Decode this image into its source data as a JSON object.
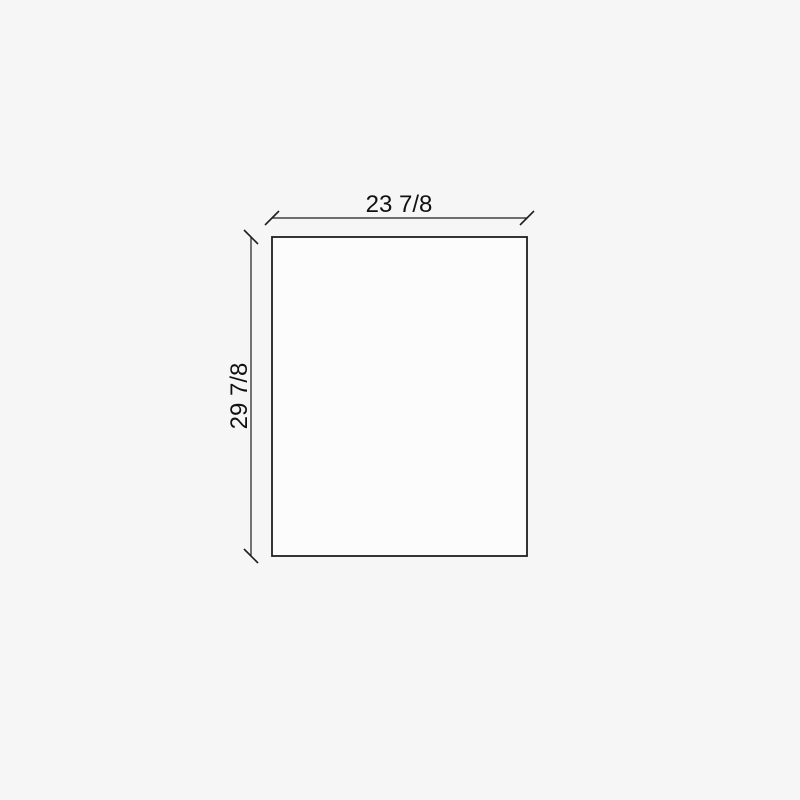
{
  "drawing": {
    "type": "technical-dimension-diagram",
    "shape": "rectangle",
    "width_dimension": {
      "label": "23 7/8"
    },
    "height_dimension": {
      "label": "29 7/8"
    },
    "colors": {
      "background": "#f6f6f6",
      "shape_fill": "#fcfcfc",
      "line": "#1f1f1f",
      "text": "#111111"
    }
  }
}
